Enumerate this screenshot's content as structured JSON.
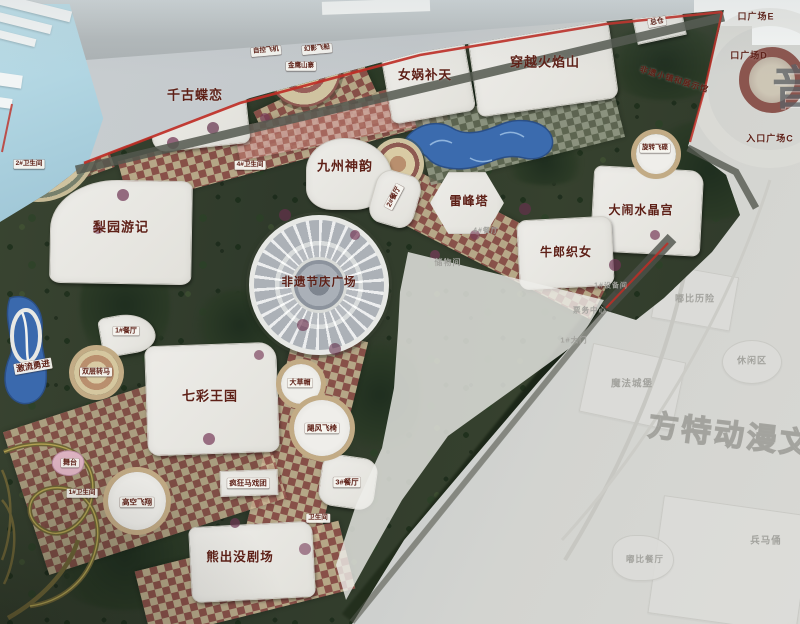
{
  "meta": {
    "kind": "photograph of a theme-park master-plan map board",
    "palette": {
      "boundary_red": "#bf2e26",
      "label_dark_red": "#5e2017",
      "faded_label_gray": "#a3a39e",
      "park_green": "#36412e",
      "water_blue": "#3c6cac",
      "path_tan": "#c9b795",
      "path_maroon": "#94544d"
    }
  },
  "park_labels": [
    {
      "id": "label-qiangu-dielian",
      "text": "千古蝶恋",
      "x": 195,
      "y": 95,
      "s": 13
    },
    {
      "id": "label-nvwa-butian",
      "text": "女娲补天",
      "x": 425,
      "y": 75,
      "s": 12.5
    },
    {
      "id": "label-chuanyue-huoyanshan",
      "text": "穿越火焰山",
      "x": 545,
      "y": 62,
      "s": 13
    },
    {
      "id": "label-jiuzhou-shenyun",
      "text": "九州神韵",
      "x": 345,
      "y": 166,
      "s": 13
    },
    {
      "id": "label-leifengta",
      "text": "雷峰塔",
      "x": 469,
      "y": 201,
      "s": 12
    },
    {
      "id": "label-danao-shuijinggong",
      "text": "大闹水晶宫",
      "x": 641,
      "y": 210,
      "s": 12
    },
    {
      "id": "label-niulang-zhinv",
      "text": "牛郎织女",
      "x": 566,
      "y": 252,
      "s": 12
    },
    {
      "id": "label-liyuan-youji",
      "text": "梨园游记",
      "x": 121,
      "y": 227,
      "s": 13
    },
    {
      "id": "label-feiyi-jieqing-guangchang",
      "text": "非遗节庆广场",
      "x": 319,
      "y": 283,
      "s": 11.5
    },
    {
      "id": "label-qicai-wangguo",
      "text": "七彩王国",
      "x": 210,
      "y": 396,
      "s": 13
    },
    {
      "id": "label-xiongchumo-juchang",
      "text": "熊出没剧场",
      "x": 240,
      "y": 557,
      "s": 12.5
    },
    {
      "id": "label-feiyi-xiaozhen",
      "text": "非遗小镇和展示馆",
      "x": 674,
      "y": 80,
      "s": 8,
      "rot": 17
    },
    {
      "id": "label-entry-plaza-e",
      "text": "口广场E",
      "x": 756,
      "y": 17,
      "s": 9
    },
    {
      "id": "label-entry-plaza-d",
      "text": "口广场D",
      "x": 749,
      "y": 56,
      "s": 9
    },
    {
      "id": "label-entry-plaza-c",
      "text": "入口广场C",
      "x": 770,
      "y": 139,
      "s": 9
    },
    {
      "id": "label-zongcang",
      "text": "总仓",
      "x": 657,
      "y": 22,
      "s": 7,
      "chip": true,
      "rot": -10
    },
    {
      "id": "label-zikong-feiji",
      "text": "自控飞机",
      "x": 266,
      "y": 51,
      "s": 6.5,
      "chip": true,
      "rot": -5
    },
    {
      "id": "label-huanying-feichuan",
      "text": "幻影飞船",
      "x": 317,
      "y": 49,
      "s": 6.5,
      "chip": true,
      "rot": -5
    },
    {
      "id": "label-jinying-shanzhai",
      "text": "金鹰山寨",
      "x": 301,
      "y": 66,
      "s": 6.5,
      "chip": true
    },
    {
      "id": "label-canteen-2",
      "text": "2#餐厅",
      "x": 394,
      "y": 197,
      "s": 7,
      "chip": true,
      "rot": -62
    },
    {
      "id": "label-wc-4",
      "text": "4#卫生间",
      "x": 250,
      "y": 165,
      "s": 6.5,
      "chip": true
    },
    {
      "id": "label-wc-2",
      "text": "2#卫生间",
      "x": 29,
      "y": 164,
      "s": 6.5,
      "chip": true
    },
    {
      "id": "label-xuanzhuan-feidie",
      "text": "旋转飞碟",
      "x": 655,
      "y": 148,
      "s": 6.5,
      "chip": true
    },
    {
      "id": "label-jiliu-yongjin",
      "text": "激流勇进",
      "x": 33,
      "y": 366,
      "s": 8.5,
      "chip": true,
      "rot": -10
    },
    {
      "id": "label-canteen-1",
      "text": "1#餐厅",
      "x": 126,
      "y": 331,
      "s": 7,
      "chip": true
    },
    {
      "id": "label-shuangceng-zhuanma",
      "text": "双层转马",
      "x": 96,
      "y": 372,
      "s": 7,
      "chip": true
    },
    {
      "id": "label-wutai",
      "text": "舞台",
      "x": 70,
      "y": 463,
      "s": 7,
      "chip": true
    },
    {
      "id": "label-wc-1",
      "text": "1#卫生间",
      "x": 82,
      "y": 493,
      "s": 6.5,
      "chip": true
    },
    {
      "id": "label-gaokong-feixiang",
      "text": "高空飞翔",
      "x": 137,
      "y": 502,
      "s": 7.5,
      "chip": true
    },
    {
      "id": "label-fengkuang-maxituan",
      "text": "疯狂马戏团",
      "x": 248,
      "y": 483,
      "s": 7.5,
      "chip": true
    },
    {
      "id": "label-dacaomao",
      "text": "大草帽",
      "x": 300,
      "y": 383,
      "s": 7,
      "chip": true
    },
    {
      "id": "label-jufeng-feiyi",
      "text": "飓风飞椅",
      "x": 322,
      "y": 428,
      "s": 7.5,
      "chip": true
    },
    {
      "id": "label-canteen-3",
      "text": "3#餐厅",
      "x": 347,
      "y": 482,
      "s": 7.5,
      "chip": true
    },
    {
      "id": "label-wc-plain",
      "text": "卫生间",
      "x": 318,
      "y": 518,
      "s": 6.5,
      "chip": true
    }
  ],
  "faint_labels": [
    {
      "id": "label-chuwujian",
      "text": "储物间",
      "x": 448,
      "y": 263,
      "s": 8
    },
    {
      "id": "label-canteen-4",
      "text": "4#餐厅",
      "x": 486,
      "y": 231,
      "s": 7
    },
    {
      "id": "label-shebeijian",
      "text": "1#设备间",
      "x": 611,
      "y": 286,
      "s": 7
    },
    {
      "id": "label-piaowu-zhongxin",
      "text": "票务中心",
      "x": 590,
      "y": 310,
      "s": 7.5
    },
    {
      "id": "label-gate-1",
      "text": "1#大门",
      "x": 574,
      "y": 340,
      "s": 7.5
    },
    {
      "id": "label-dubi-lixian",
      "text": "嘟比历险",
      "x": 695,
      "y": 299,
      "s": 9
    },
    {
      "id": "label-xiuxianqu",
      "text": "休闲区",
      "x": 752,
      "y": 361,
      "s": 9
    },
    {
      "id": "label-mofa-chengbao",
      "text": "魔法城堡",
      "x": 632,
      "y": 384,
      "s": 9.5
    },
    {
      "id": "label-dubi-canting",
      "text": "嘟比餐厅",
      "x": 645,
      "y": 559,
      "s": 8.5
    },
    {
      "id": "label-bingmayong",
      "text": "兵马俑",
      "x": 766,
      "y": 541,
      "s": 9.5
    }
  ],
  "watermarks": {
    "big_char": "音",
    "outline_text": "方特动漫文化科"
  }
}
